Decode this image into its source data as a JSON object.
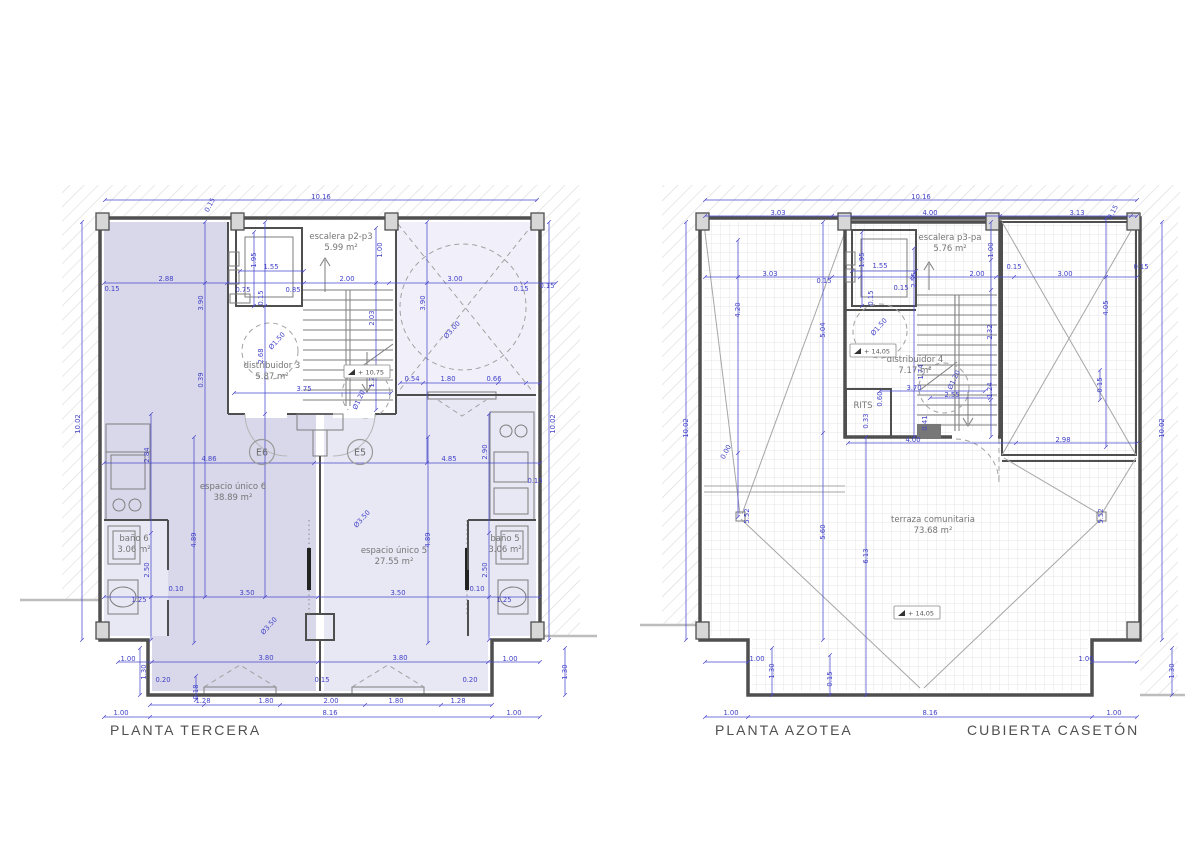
{
  "colors": {
    "dimension_blue": "#4343c8",
    "wall_gray": "#4f4f4f",
    "room_tint_dark": "#d9d7ea",
    "room_tint_light": "#e8e7f4",
    "patio_tint": "#f1f0fa"
  },
  "plans": [
    {
      "id": "planta-tercera",
      "title": "PLANTA TERCERA",
      "rooms": [
        {
          "lines": [
            "escalera p2-p3",
            "5.99 m²"
          ],
          "x": 341,
          "y": 239
        },
        {
          "lines": [
            "distribuidor 3",
            "5.87 m²"
          ],
          "x": 272,
          "y": 368
        },
        {
          "lines": [
            "espacio único 6",
            "38.89 m²"
          ],
          "x": 233,
          "y": 489
        },
        {
          "lines": [
            "espacio único 5",
            "27.55 m²"
          ],
          "x": 394,
          "y": 553
        },
        {
          "lines": [
            "baño 6",
            "3.06 m²"
          ],
          "x": 134,
          "y": 541
        },
        {
          "lines": [
            "baño 5",
            "3.06 m²"
          ],
          "x": 505,
          "y": 541
        }
      ],
      "markers": [
        {
          "t": "E6",
          "x": 262,
          "y": 452
        },
        {
          "t": "E5",
          "x": 360,
          "y": 452
        }
      ],
      "levels": [
        {
          "t": "+ 10,75",
          "x": 367,
          "y": 373
        }
      ],
      "dimensions": [
        [
          "10.16",
          321,
          197,
          0
        ],
        [
          "0.15",
          210,
          205,
          -62
        ],
        [
          "2.88",
          166,
          279,
          0
        ],
        [
          "0.15",
          112,
          289,
          0
        ],
        [
          "1.95",
          254,
          260,
          -90
        ],
        [
          "1.55",
          271,
          267,
          0
        ],
        [
          "0.75",
          243,
          290,
          0
        ],
        [
          "0.85",
          293,
          290,
          0
        ],
        [
          "0.15",
          261,
          298,
          -90
        ],
        [
          "2.00",
          347,
          279,
          0
        ],
        [
          "1.00",
          380,
          250,
          -90
        ],
        [
          "3.00",
          455,
          279,
          0
        ],
        [
          "0.15",
          521,
          289,
          0
        ],
        [
          "0.15",
          547,
          286,
          0
        ],
        [
          "3.90",
          201,
          303,
          -90
        ],
        [
          "3.90",
          423,
          303,
          -90
        ],
        [
          "2.03",
          372,
          318,
          -90
        ],
        [
          "Ø3.00",
          452,
          330,
          -48
        ],
        [
          "Ø1.50",
          277,
          341,
          -48
        ],
        [
          "2.68",
          261,
          356,
          -90
        ],
        [
          "0.39",
          201,
          380,
          -90
        ],
        [
          "1.20",
          372,
          380,
          -90
        ],
        [
          "Ø1.20",
          359,
          400,
          -65
        ],
        [
          "0.54",
          412,
          379,
          0
        ],
        [
          "1.80",
          448,
          379,
          0
        ],
        [
          "0.66",
          494,
          379,
          0
        ],
        [
          "3.75",
          304,
          389,
          0
        ],
        [
          "10.02",
          78,
          424,
          -90
        ],
        [
          "10.02",
          553,
          424,
          -90
        ],
        [
          "2.84",
          147,
          455,
          -90
        ],
        [
          "2.90",
          485,
          452,
          -90
        ],
        [
          "4.86",
          209,
          459,
          0
        ],
        [
          "4.85",
          449,
          459,
          0
        ],
        [
          "0.15",
          535,
          481,
          0
        ],
        [
          "4.89",
          194,
          540,
          -90
        ],
        [
          "4.89",
          428,
          540,
          -90
        ],
        [
          "Ø3.50",
          362,
          519,
          -48
        ],
        [
          "Ø3.50",
          269,
          626,
          -48
        ],
        [
          "3.50",
          247,
          593,
          0
        ],
        [
          "3.50",
          398,
          593,
          0
        ],
        [
          "0.10",
          176,
          589,
          0
        ],
        [
          "0.10",
          477,
          589,
          0
        ],
        [
          "1.25",
          139,
          600,
          0
        ],
        [
          "1.25",
          504,
          600,
          0
        ],
        [
          "2.50",
          147,
          570,
          -90
        ],
        [
          "2.50",
          485,
          570,
          -90
        ],
        [
          "1.00",
          128,
          659,
          0
        ],
        [
          "1.30",
          144,
          672,
          -90
        ],
        [
          "3.80",
          266,
          658,
          0
        ],
        [
          "3.80",
          400,
          658,
          0
        ],
        [
          "1.00",
          510,
          659,
          0
        ],
        [
          "0.20",
          163,
          680,
          0
        ],
        [
          "0.18",
          196,
          692,
          -90
        ],
        [
          "0.15",
          322,
          680,
          0
        ],
        [
          "0.20",
          470,
          680,
          0
        ],
        [
          "1.30",
          565,
          672,
          -90
        ],
        [
          "1.28",
          203,
          701,
          0
        ],
        [
          "1.80",
          266,
          701,
          0
        ],
        [
          "2.00",
          331,
          701,
          0
        ],
        [
          "1.80",
          396,
          701,
          0
        ],
        [
          "1.28",
          458,
          701,
          0
        ],
        [
          "1.00",
          121,
          713,
          0
        ],
        [
          "8.16",
          330,
          713,
          0
        ],
        [
          "1.00",
          514,
          713,
          0
        ]
      ]
    },
    {
      "id": "planta-azotea",
      "title": "PLANTA AZOTEA",
      "subtitle": "CUBIERTA CASETÓN",
      "rooms": [
        {
          "lines": [
            "escalera p3-pa",
            "5.76 m²"
          ],
          "x": 950,
          "y": 240
        },
        {
          "lines": [
            "distribuidor 4",
            "7.17 m²"
          ],
          "x": 915,
          "y": 362
        },
        {
          "lines": [
            "RITS"
          ],
          "x": 863,
          "y": 408
        },
        {
          "lines": [
            "terraza comunitaria",
            "73.68 m²"
          ],
          "x": 933,
          "y": 522
        }
      ],
      "markers": [],
      "levels": [
        {
          "t": "+ 14,05",
          "x": 873,
          "y": 352
        },
        {
          "t": "+ 14,05",
          "x": 917,
          "y": 614
        }
      ],
      "dimensions": [
        [
          "10.16",
          921,
          197,
          0
        ],
        [
          "3.03",
          778,
          213,
          0
        ],
        [
          "4.00",
          930,
          213,
          0
        ],
        [
          "3.13",
          1077,
          213,
          0
        ],
        [
          "0.15",
          1113,
          212,
          -62
        ],
        [
          "3.03",
          770,
          274,
          0
        ],
        [
          "0.15",
          824,
          281,
          0
        ],
        [
          "1.95",
          862,
          260,
          -90
        ],
        [
          "1.55",
          880,
          266,
          0
        ],
        [
          "0.15",
          871,
          298,
          -90
        ],
        [
          "0.15",
          901,
          288,
          0
        ],
        [
          "2.55",
          914,
          280,
          -90
        ],
        [
          "2.00",
          977,
          274,
          0
        ],
        [
          "1.00",
          991,
          250,
          -90
        ],
        [
          "0.15",
          1014,
          267,
          0
        ],
        [
          "3.00",
          1065,
          274,
          0
        ],
        [
          "0.15",
          1141,
          267,
          0
        ],
        [
          "4.20",
          738,
          310,
          -90
        ],
        [
          "4.05",
          1106,
          308,
          -90
        ],
        [
          "5.04",
          823,
          330,
          -90
        ],
        [
          "Ø1.50",
          879,
          327,
          -48
        ],
        [
          "2.32",
          990,
          332,
          -90
        ],
        [
          "1.74",
          921,
          372,
          -90
        ],
        [
          "Ø1.20",
          954,
          380,
          -65
        ],
        [
          "1.24",
          990,
          390,
          -90
        ],
        [
          "3.70",
          914,
          388,
          0
        ],
        [
          "2.55",
          952,
          395,
          0
        ],
        [
          "0.60",
          880,
          399,
          -90
        ],
        [
          "0.33",
          866,
          421,
          -90
        ],
        [
          "0.41",
          925,
          423,
          -90
        ],
        [
          "0.15",
          1100,
          385,
          -90
        ],
        [
          "10.02",
          686,
          428,
          -90
        ],
        [
          "10.02",
          1162,
          428,
          -90
        ],
        [
          "0.00",
          726,
          452,
          -62
        ],
        [
          "4.00",
          913,
          440,
          0
        ],
        [
          "2.98",
          1063,
          440,
          0
        ],
        [
          "5.52",
          747,
          516,
          -90
        ],
        [
          "5.52",
          1101,
          516,
          -90
        ],
        [
          "5.60",
          823,
          532,
          -90
        ],
        [
          "6.13",
          866,
          556,
          -90
        ],
        [
          "0.15",
          830,
          679,
          -90
        ],
        [
          "1.00",
          757,
          659,
          0
        ],
        [
          "1.30",
          772,
          671,
          -90
        ],
        [
          "1.00",
          1086,
          659,
          0
        ],
        [
          "1.30",
          1172,
          671,
          -90
        ],
        [
          "1.00",
          731,
          713,
          0
        ],
        [
          "8.16",
          930,
          713,
          0
        ],
        [
          "1.00",
          1114,
          713,
          0
        ]
      ]
    }
  ]
}
